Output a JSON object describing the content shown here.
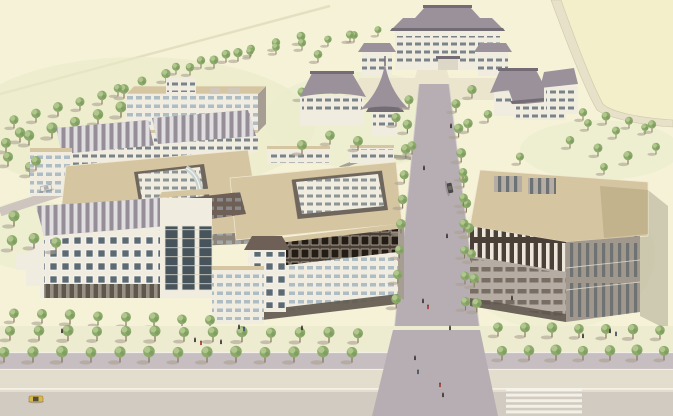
{
  "meta": {
    "description": "Aerial perspective architectural rendering of a campus master plan: a traditional-roofed main hall and gate pavilions to the north, two modern academic complexes with tan flat roofs to the west and center, a large library block to the east, a tree-lined central avenue and a wide south boulevard with crosswalk, cars and pedestrians."
  },
  "palette": {
    "cream": "#f5f2d8",
    "field": "#f3efca",
    "lawn": "#e7ebc9",
    "ave": "#b6aeb2",
    "sidewalk": "#edebd0",
    "median": "#c6bec0",
    "road1": "#e3ddcd",
    "road2": "#d2cbc1",
    "path": "#ebe5cd",
    "tan": "#d5c5a0",
    "tanD": "#b5a47e",
    "rib": "#968e96",
    "ribS": "#e9e7ea",
    "fac": "#f0ece0",
    "facS": "#cfc8bb",
    "facD": "#a79e93",
    "winB": "#aebdc4",
    "winD": "#5c6a72",
    "brown": "#4b4037",
    "mans": "#6e6057",
    "stone": "#b5aca3",
    "stoneD": "#a0978d",
    "proof": "#9a919b",
    "proofD": "#746c75",
    "treeG": "#8cab6b",
    "treeL": "#b6ca92",
    "trunk": "#8a7a62",
    "shadow": "#aaa291",
    "taxi": "#d9b84a",
    "carDark": "#4a4745",
    "carWhite": "#eceae4"
  },
  "scene": {
    "vegetation": {
      "rows": [
        {
          "layer": "back",
          "x": 14,
          "y": 128,
          "n": 6,
          "dx": 22,
          "dy": -6,
          "s": 0.85
        },
        {
          "layer": "back",
          "x": 6,
          "y": 152,
          "n": 7,
          "dx": 23,
          "dy": -7,
          "s": 0.95
        },
        {
          "layer": "back",
          "x": 30,
          "y": 176,
          "n": 4,
          "dx": 20,
          "dy": -6,
          "s": 0.95
        },
        {
          "layer": "back",
          "x": 118,
          "y": 96,
          "n": 6,
          "dx": 24,
          "dy": -7,
          "s": 0.8
        },
        {
          "layer": "back",
          "x": 176,
          "y": 74,
          "n": 6,
          "dx": 25,
          "dy": -6,
          "s": 0.75
        },
        {
          "layer": "back",
          "x": 250,
          "y": 58,
          "n": 5,
          "dx": 26,
          "dy": -4,
          "s": 0.7
        },
        {
          "layer": "back",
          "x": 560,
          "y": 116,
          "n": 5,
          "dx": 23,
          "dy": 4,
          "s": 0.75
        },
        {
          "layer": "mid",
          "x": 409,
          "y": 108,
          "n": 9,
          "dx": -1.6,
          "dy": 25,
          "s": 0.85
        },
        {
          "layer": "mid",
          "x": 456,
          "y": 112,
          "n": 9,
          "dx": 2.6,
          "dy": 25,
          "s": 0.85
        },
        {
          "layer": "mid",
          "x": 463,
          "y": 180,
          "n": 6,
          "dx": 0.5,
          "dy": 26,
          "s": 0.8
        },
        {
          "layer": "mid",
          "x": 14,
          "y": 322,
          "n": 8,
          "dx": 28,
          "dy": 1,
          "s": 0.9
        },
        {
          "layer": "front",
          "x": 10,
          "y": 340,
          "n": 13,
          "dx": 29,
          "dy": 0.2,
          "s": 0.95
        },
        {
          "layer": "front",
          "x": 4,
          "y": 362,
          "n": 13,
          "dx": 29,
          "dy": 0,
          "s": 1.0
        },
        {
          "layer": "front",
          "x": 498,
          "y": 336,
          "n": 7,
          "dx": 27,
          "dy": 0.5,
          "s": 0.9
        },
        {
          "layer": "front",
          "x": 502,
          "y": 360,
          "n": 7,
          "dx": 27,
          "dy": 0,
          "s": 0.95
        }
      ],
      "scatter": [
        {
          "layer": "back",
          "pts": [
            [
              318,
              62,
              0.8
            ],
            [
              302,
              100,
              0.8
            ],
            [
              340,
              92,
              0.8
            ],
            [
              418,
              62,
              0.7
            ],
            [
              458,
              66,
              0.7
            ],
            [
              350,
              42,
              0.7
            ],
            [
              378,
              36,
              0.65
            ],
            [
              588,
              130,
              0.7
            ],
            [
              616,
              138,
              0.7
            ],
            [
              645,
              134,
              0.7
            ]
          ]
        },
        {
          "layer": "mid",
          "pts": [
            [
              330,
              144,
              0.9
            ],
            [
              358,
              150,
              0.9
            ],
            [
              396,
              126,
              0.8
            ],
            [
              412,
              154,
              0.85
            ],
            [
              302,
              154,
              0.9
            ],
            [
              472,
              98,
              0.8
            ],
            [
              488,
              122,
              0.8
            ],
            [
              468,
              132,
              0.85
            ],
            [
              520,
              164,
              0.7
            ],
            [
              570,
              148,
              0.8
            ],
            [
              598,
              156,
              0.8
            ],
            [
              628,
              164,
              0.8
            ],
            [
              656,
              154,
              0.75
            ],
            [
              604,
              174,
              0.7
            ],
            [
              20,
              142,
              0.9
            ],
            [
              8,
              166,
              0.95
            ],
            [
              36,
              170,
              0.9
            ],
            [
              14,
              226,
              0.95
            ],
            [
              34,
              248,
              1.0
            ],
            [
              12,
              250,
              0.95
            ],
            [
              56,
              252,
              0.9
            ]
          ]
        }
      ]
    },
    "pedestrians": [
      [
        423,
        303,
        0
      ],
      [
        428,
        309,
        1
      ],
      [
        450,
        330,
        0
      ],
      [
        415,
        360,
        0
      ],
      [
        418,
        374,
        2
      ],
      [
        440,
        387,
        1
      ],
      [
        443,
        397,
        0
      ],
      [
        447,
        238,
        0
      ],
      [
        451,
        128,
        0
      ],
      [
        424,
        170,
        0
      ],
      [
        512,
        300,
        0
      ],
      [
        583,
        338,
        0
      ],
      [
        610,
        333,
        0
      ],
      [
        616,
        336,
        2
      ],
      [
        195,
        342,
        0
      ],
      [
        201,
        345,
        1
      ],
      [
        221,
        344,
        0
      ],
      [
        62,
        333,
        0
      ],
      [
        302,
        330,
        0
      ],
      [
        239,
        329,
        0
      ],
      [
        244,
        331,
        2
      ]
    ],
    "pedestrian_colors": [
      "#3f3a38",
      "#a8433a",
      "#3c5a78"
    ],
    "vehicles": [
      {
        "type": "taxi",
        "x": 36,
        "y": 399,
        "rot": 0
      },
      {
        "type": "car-dark",
        "x": 450,
        "y": 188,
        "rot": 78
      },
      {
        "type": "car-white",
        "x": 46,
        "y": 188,
        "rot": -12
      }
    ],
    "crosswalk": {
      "x": 506,
      "y": 388,
      "count": 5,
      "w": 76,
      "h": 3,
      "dy": 5.6
    }
  }
}
